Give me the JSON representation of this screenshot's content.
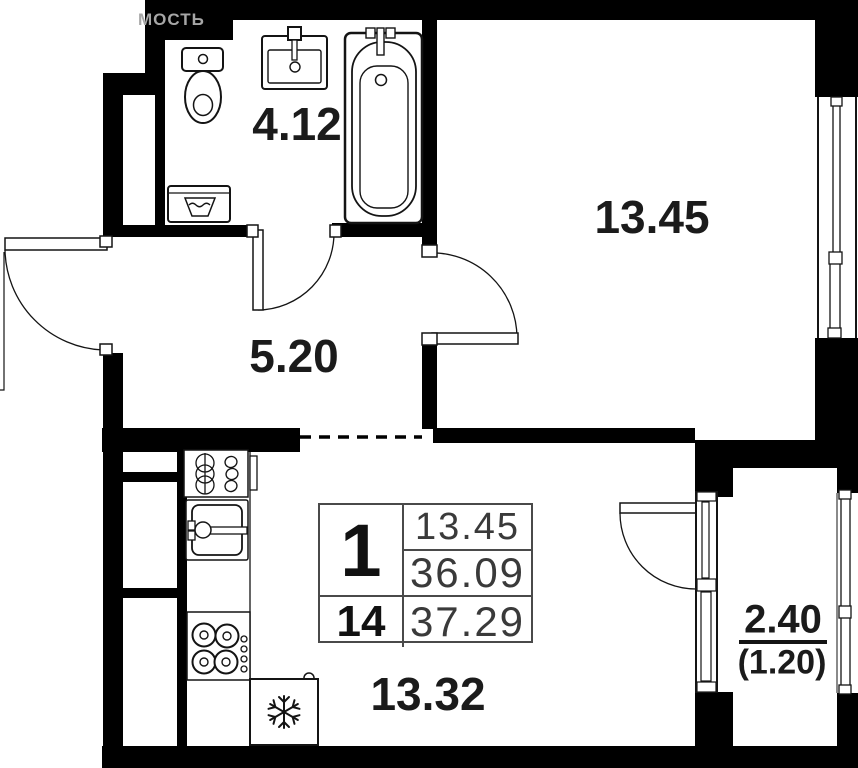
{
  "watermark": {
    "text": "МОСТЬ"
  },
  "rooms": {
    "bathroom": {
      "area": "4.12"
    },
    "hallway": {
      "area": "5.20"
    },
    "bedroom": {
      "area": "13.45"
    },
    "kitchen_living": {
      "area": "13.32"
    },
    "balcony": {
      "area": "2.40",
      "area_secondary": "(1.20)"
    }
  },
  "info_table": {
    "rooms_count": "1",
    "floor": "14",
    "living_area": "13.45",
    "area_without_summer": "36.09",
    "total_area": "37.29"
  },
  "fixtures": {
    "bathroom": [
      "toilet-icon",
      "bathroom-sink-icon",
      "bathtub-icon",
      "washing-machine-icon"
    ],
    "kitchen": [
      "kitchen-counter-unit-icon",
      "kitchen-sink-icon",
      "stove-icon",
      "fridge-snowflake-icon"
    ]
  },
  "colors": {
    "walls": "#000000",
    "labels": "#1b1b1b",
    "table_numbers": "#3a3a3a",
    "table_border": "#4a4a4a",
    "watermark": "#a6a6a6"
  }
}
